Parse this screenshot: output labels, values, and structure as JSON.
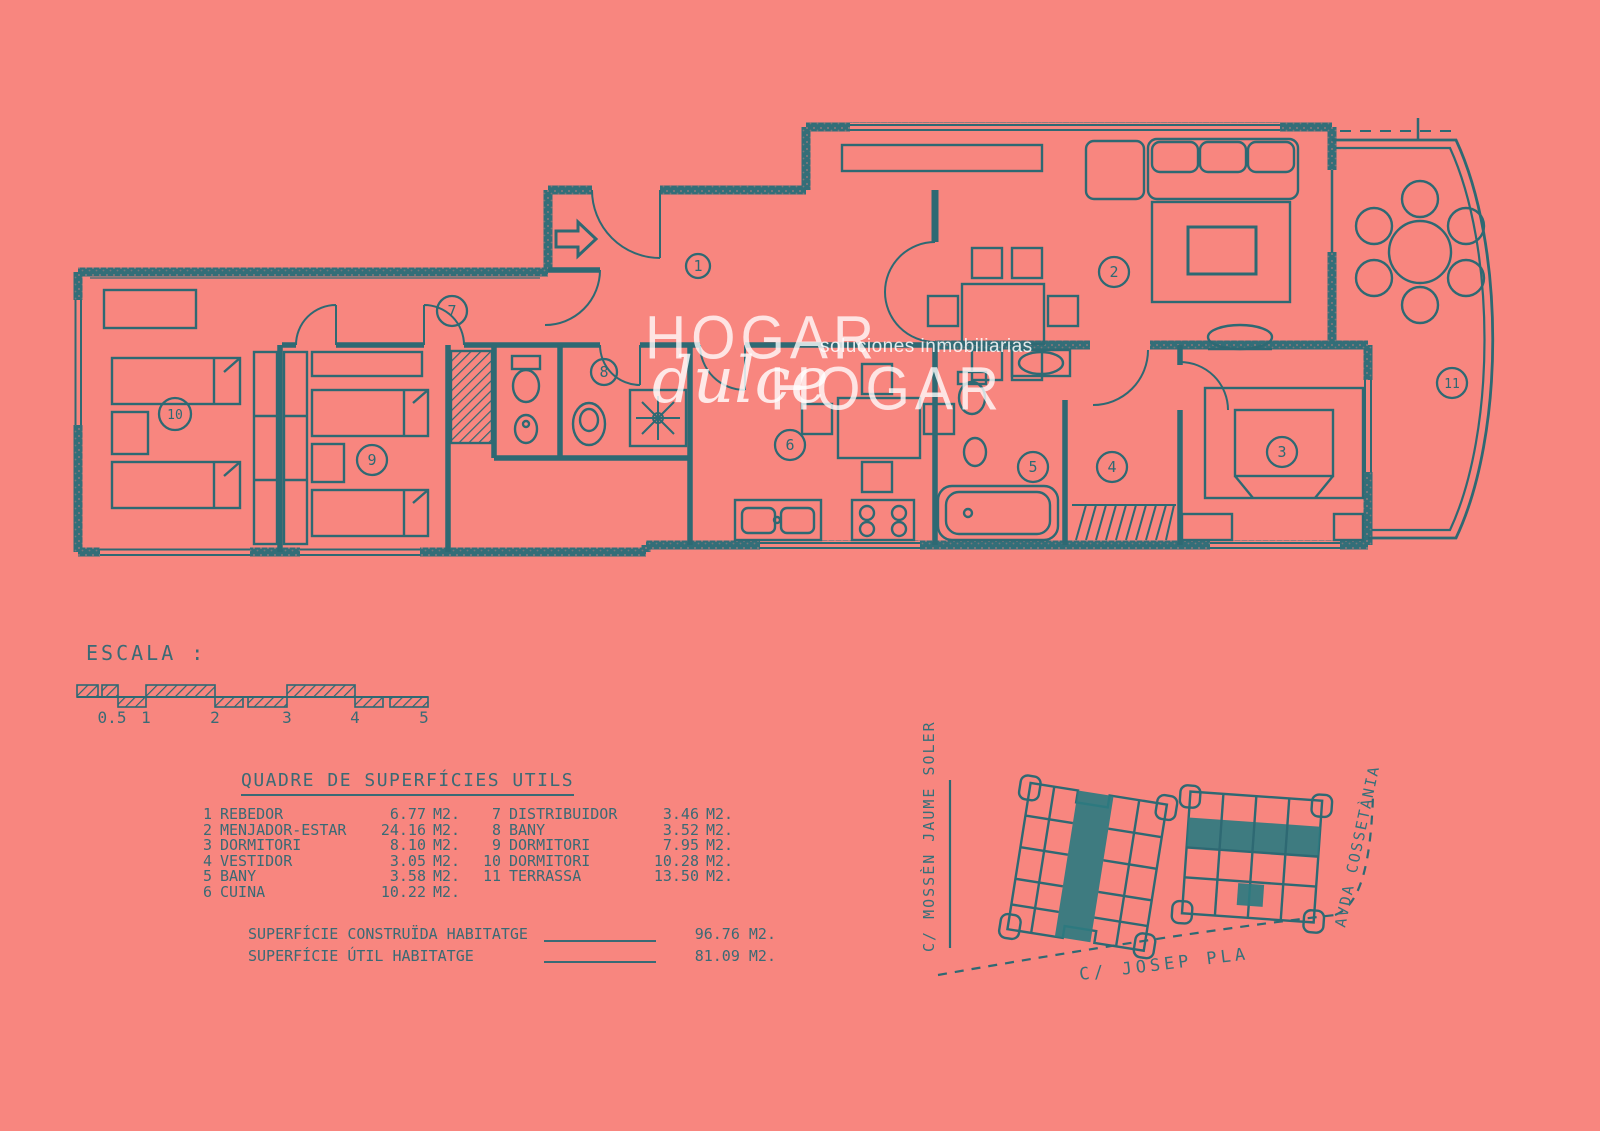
{
  "page": {
    "background": "#f8867f",
    "ink": "#2e6973",
    "highlight": "#2e7b80"
  },
  "watermark": {
    "word1": "HOGAR",
    "script_word": "dulce",
    "word2": "HOGAR",
    "tagline": "soluciones inmobiliarias"
  },
  "plan": {
    "room_numbers": [
      "1",
      "2",
      "3",
      "4",
      "5",
      "6",
      "7",
      "8",
      "9",
      "10",
      "11"
    ]
  },
  "scale": {
    "label": "ESCALA :",
    "ticks": [
      "0.5",
      "1",
      "2",
      "3",
      "4",
      "5"
    ]
  },
  "surfaces": {
    "title": "QUADRE DE SUPERFÍCIES UTILS",
    "left_rows": [
      {
        "num": "1",
        "name": "REBEDOR",
        "area": "6.77",
        "unit": "M2."
      },
      {
        "num": "2",
        "name": "MENJADOR-ESTAR",
        "area": "24.16",
        "unit": "M2."
      },
      {
        "num": "3",
        "name": "DORMITORI",
        "area": "8.10",
        "unit": "M2."
      },
      {
        "num": "4",
        "name": "VESTIDOR",
        "area": "3.05",
        "unit": "M2."
      },
      {
        "num": "5",
        "name": "BANY",
        "area": "3.58",
        "unit": "M2."
      },
      {
        "num": "6",
        "name": "CUINA",
        "area": "10.22",
        "unit": "M2."
      }
    ],
    "right_rows": [
      {
        "num": "7",
        "name": "DISTRIBUIDOR",
        "area": "3.46",
        "unit": "M2."
      },
      {
        "num": "8",
        "name": "BANY",
        "area": "3.52",
        "unit": "M2."
      },
      {
        "num": "9",
        "name": "DORMITORI",
        "area": "7.95",
        "unit": "M2."
      },
      {
        "num": "10",
        "name": "DORMITORI",
        "area": "10.28",
        "unit": "M2."
      },
      {
        "num": "11",
        "name": "TERRASSA",
        "area": "13.50",
        "unit": "M2."
      }
    ],
    "totals": [
      {
        "label": "SUPERFÍCIE CONSTRUÏDA HABITATGE",
        "value": "96.76 M2."
      },
      {
        "label": "SUPERFÍCIE ÚTIL HABITATGE",
        "value": "81.09 M2."
      }
    ]
  },
  "sitemap": {
    "streets": [
      {
        "name": "C/ MOSSÈN JAUME SOLER"
      },
      {
        "name": "AVDA COSSETÀNIA"
      },
      {
        "name": "C/ JOSEP PLA"
      }
    ]
  }
}
